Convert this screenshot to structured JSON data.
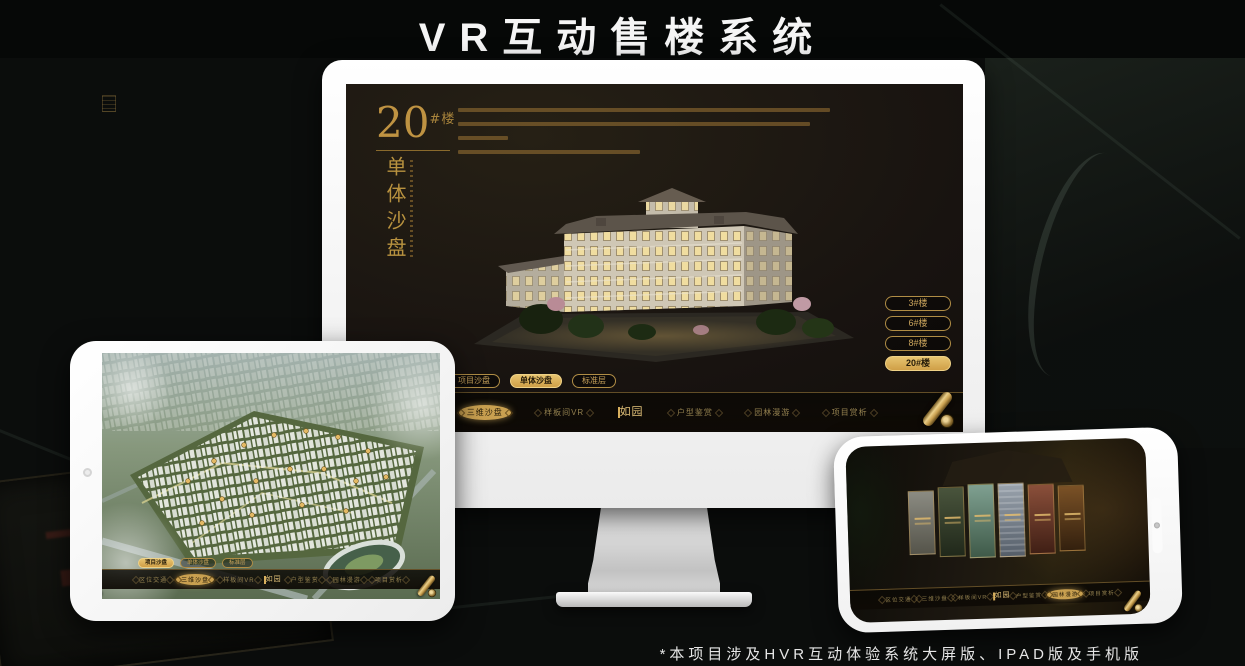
{
  "page": {
    "title": "VR互动售楼系统",
    "footnote": "*本项目涉及HVR互动体验系统大屏版、IPAD版及手机版"
  },
  "colors": {
    "gold": "#c9a050",
    "gold_bright": "#e7c470",
    "screen_background": "#181310",
    "device_frame": "#ffffff",
    "title_text": "#f5f5f5"
  },
  "nav": {
    "left": [
      {
        "label": "区位交通"
      },
      {
        "label": "三维沙盘"
      },
      {
        "label": "样板间VR"
      }
    ],
    "logo": "如园",
    "right": [
      {
        "label": "户型鉴赏"
      },
      {
        "label": "园林漫游"
      },
      {
        "label": "项目赏析"
      }
    ]
  },
  "subtabs": [
    {
      "label": "项目沙盘"
    },
    {
      "label": "单体沙盘"
    },
    {
      "label": "标准层"
    }
  ],
  "monitor": {
    "headline": {
      "number": "20",
      "suffix": "#楼",
      "vertical": "单体沙盘"
    },
    "building_buttons": [
      {
        "label": "3#楼",
        "active": false
      },
      {
        "label": "6#楼",
        "active": false
      },
      {
        "label": "8#楼",
        "active": false
      },
      {
        "label": "20#楼",
        "active": true
      }
    ],
    "active_subtab": "单体沙盘",
    "active_nav": "三维沙盘"
  },
  "tablet": {
    "active_subtab": "项目沙盘",
    "active_nav": "三维沙盘"
  },
  "phone": {
    "active_nav": "园林漫游"
  }
}
